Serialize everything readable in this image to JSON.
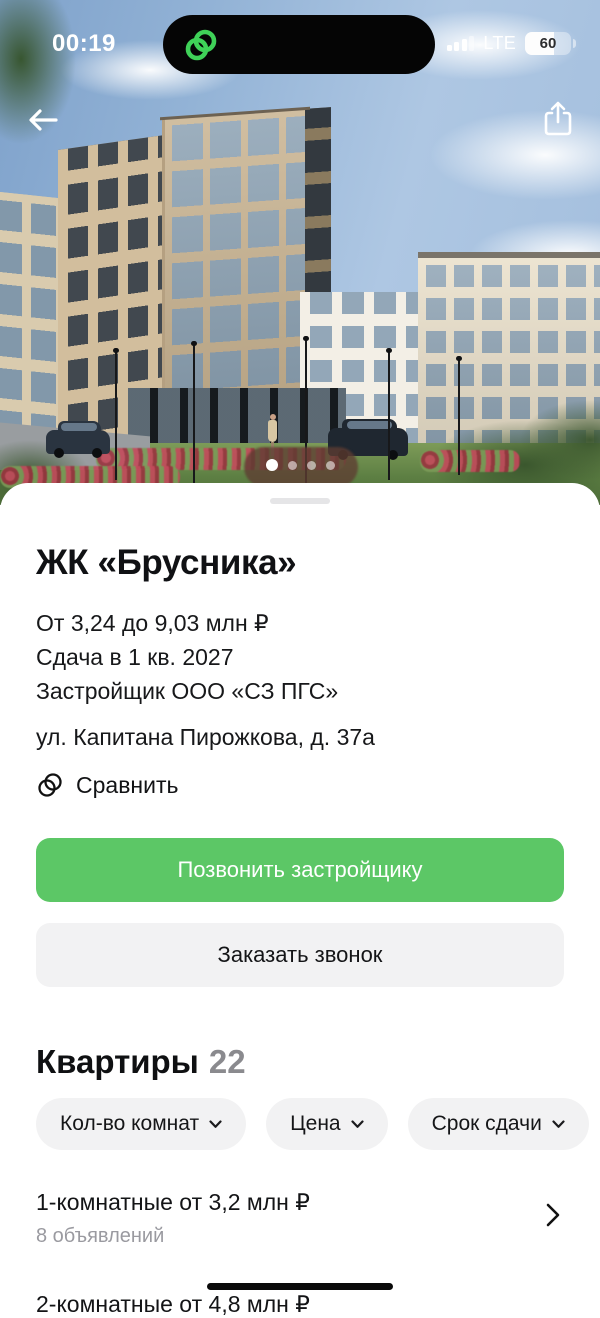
{
  "status_bar": {
    "time": "00:19",
    "network": "LTE",
    "battery_percent": "60"
  },
  "hero": {
    "carousel_dot_count": 4,
    "active_dot": 1
  },
  "listing": {
    "title": "ЖК «Брусника»",
    "price_range": "От 3,24 до 9,03 млн ₽",
    "completion": "Сдача в 1 кв. 2027",
    "developer": "Застройщик ООО «СЗ ПГС»",
    "address": "ул. Капитана Пирожкова, д. 37а",
    "compare_label": "Сравнить",
    "call_button": "Позвонить застройщику",
    "request_call_button": "Заказать звонок"
  },
  "apartments": {
    "section_title": "Квартиры",
    "count": "22",
    "filters": [
      {
        "label": "Кол-во комнат"
      },
      {
        "label": "Цена"
      },
      {
        "label": "Срок сдачи"
      },
      {
        "label": "Площадь"
      }
    ],
    "items": [
      {
        "title": "1-комнатные от 3,2 млн ₽",
        "subtitle": "8 объявлений"
      },
      {
        "title": "2-комнатные от 4,8 млн ₽",
        "subtitle": ""
      }
    ]
  },
  "colors": {
    "accent_green": "#5cc766",
    "island_logo_green": "#3fd158",
    "chip_bg": "#f2f2f3",
    "muted_text": "#9a9aa0"
  }
}
